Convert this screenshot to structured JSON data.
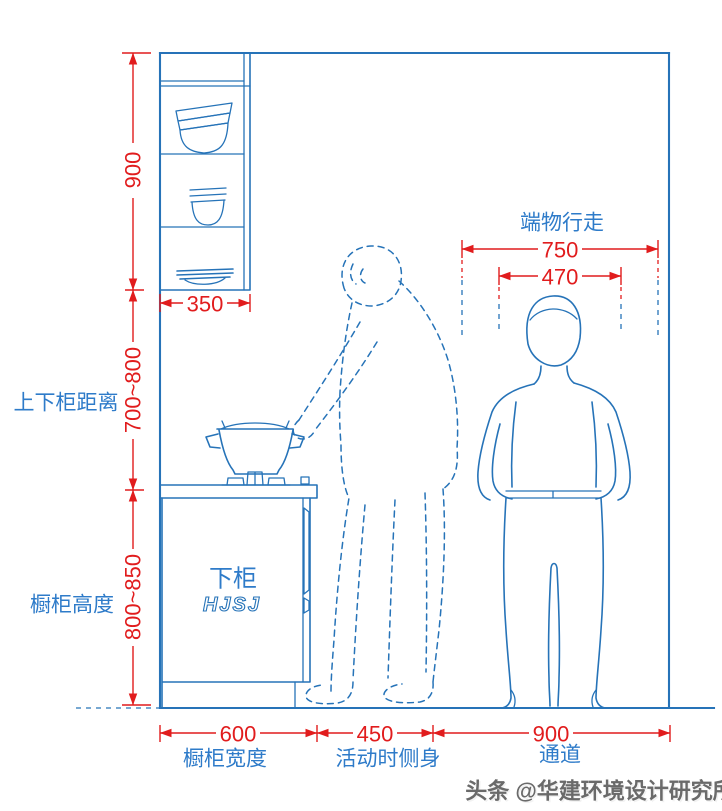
{
  "colors": {
    "line_blue": "#2673b8",
    "text_blue": "#2e7bc9",
    "dimension_red": "#e11c1d",
    "watermark_gray": "#6a6a6a",
    "background": "#ffffff"
  },
  "labels": {
    "gap_label": "上下柜距离",
    "cabinet_height_label": "橱柜高度",
    "carry_walk_label": "端物行走",
    "lower_cabinet_label": "下柜",
    "logo": "HJSJ",
    "cabinet_width_label": "橱柜宽度",
    "side_move_label": "活动时侧身",
    "passage_label": "通道"
  },
  "dims": {
    "upper_height": "900",
    "upper_depth": "350",
    "gap_range": "700~800",
    "base_range": "800~850",
    "walk": "750",
    "carry": "470",
    "base_width": "600",
    "side": "450",
    "passage": "900"
  },
  "watermark": "头条 @华建环境设计研究所"
}
